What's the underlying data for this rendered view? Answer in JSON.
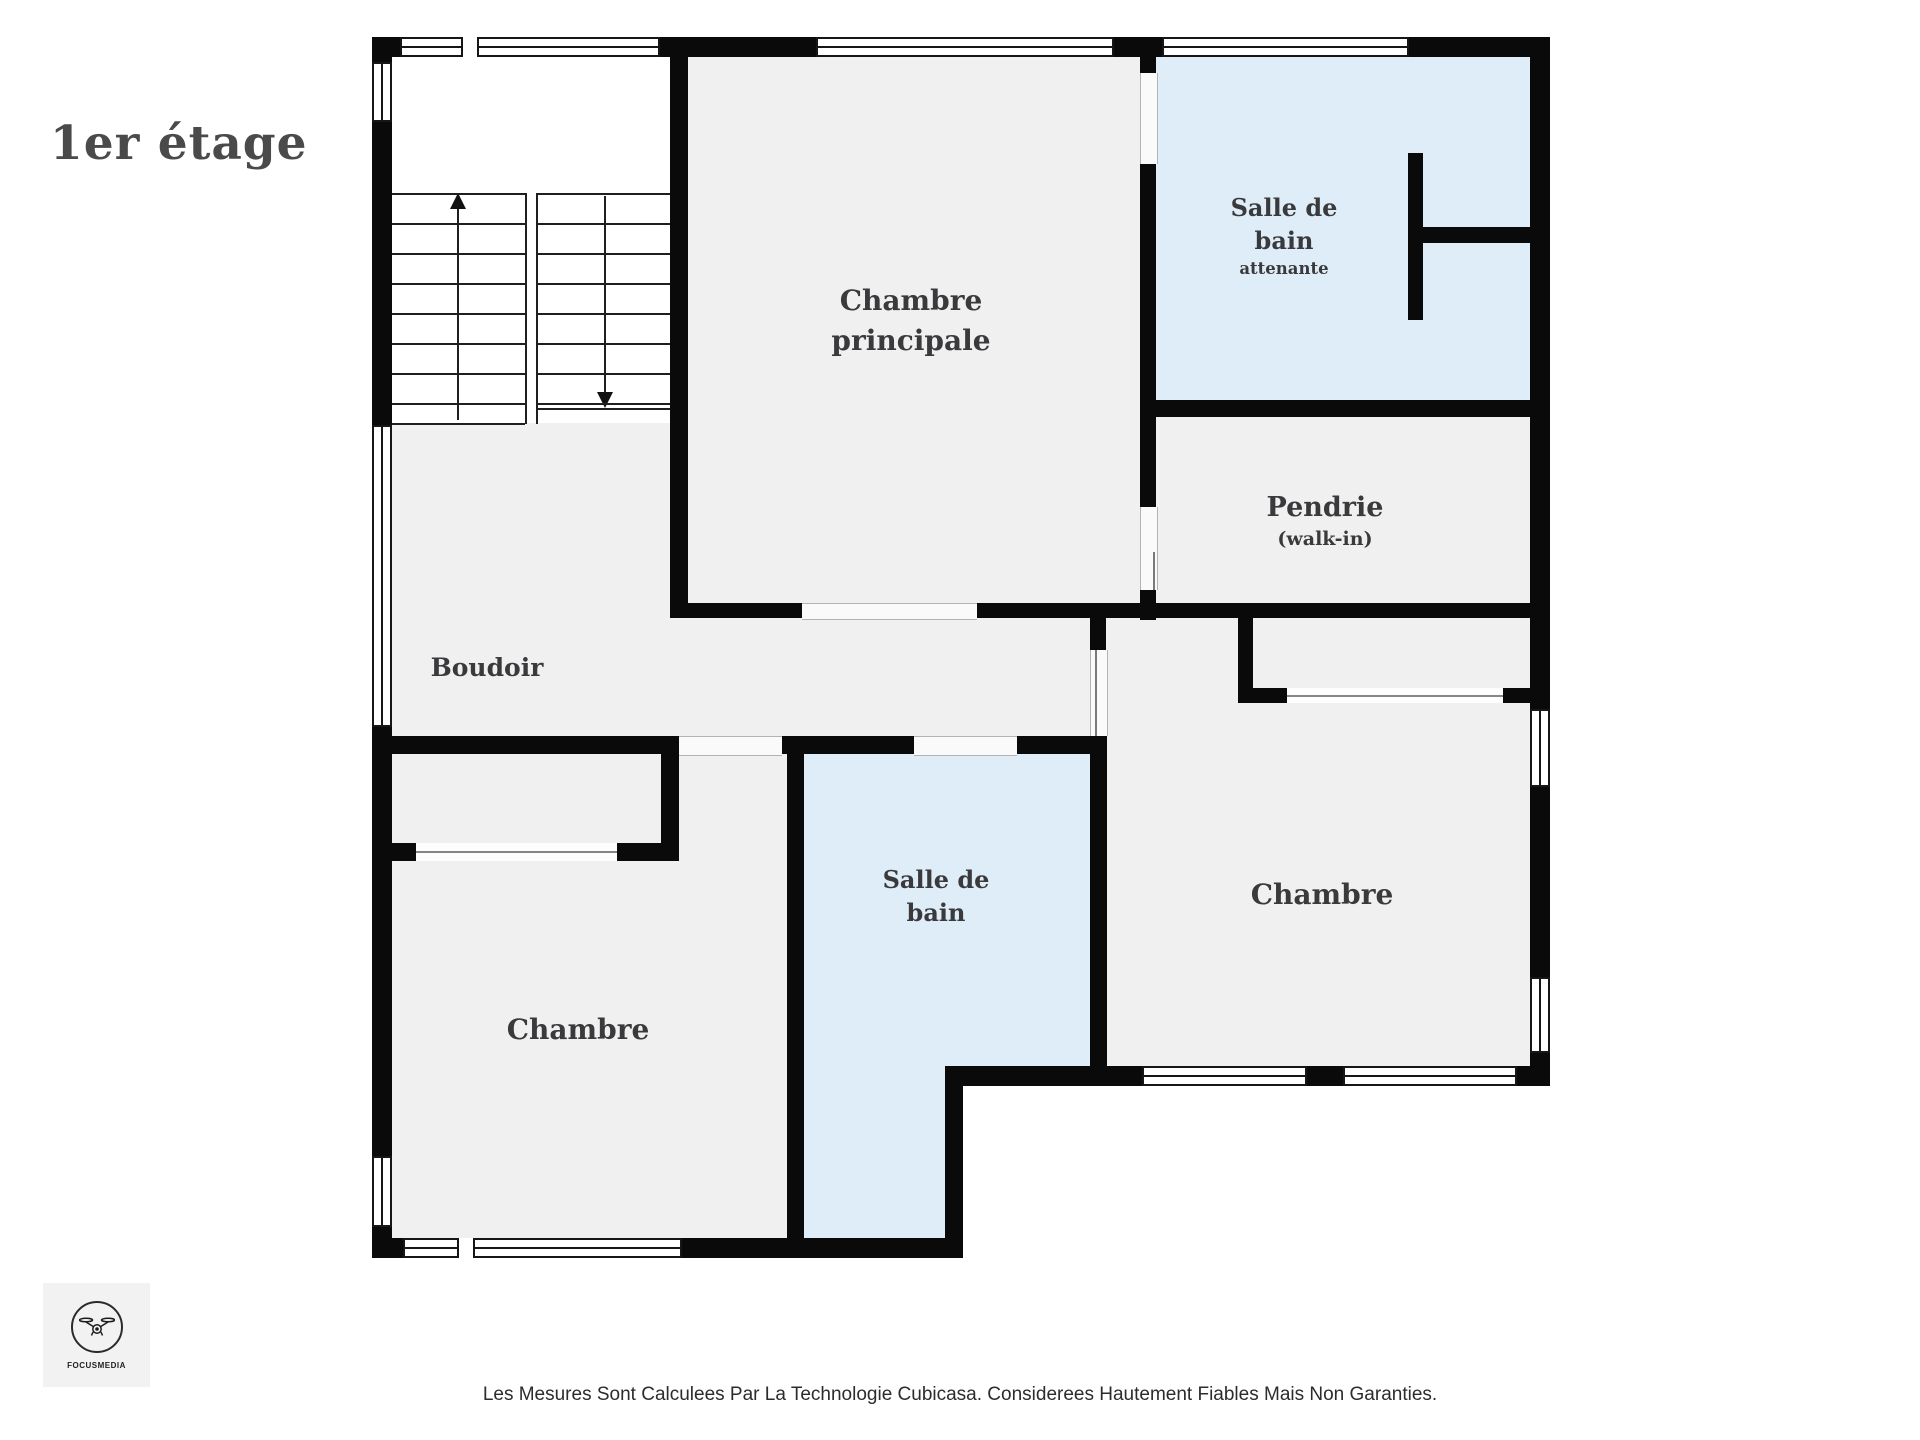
{
  "title": "1er étage",
  "rooms": {
    "master_bedroom": {
      "line1": "Chambre",
      "line2": "principale"
    },
    "ensuite_bathroom": {
      "line1": "Salle de",
      "line2": "bain",
      "line3": "attenante"
    },
    "walk_in": {
      "line1": "Pendrie",
      "line2": "(walk-in)"
    },
    "boudoir": {
      "label": "Boudoir"
    },
    "bedroom_left": {
      "label": "Chambre"
    },
    "bathroom_main": {
      "line1": "Salle de",
      "line2": "bain"
    },
    "bedroom_right": {
      "label": "Chambre"
    }
  },
  "footer": {
    "disclaimer": "Les Mesures Sont Calculees Par La Technologie Cubicasa. Considerees Hautement Fiables Mais Non Garanties."
  },
  "logo": {
    "brand": "FOCUSMEDIA"
  },
  "icons": {
    "logo": "drone-icon",
    "stairs_up": "up-arrow-icon",
    "stairs_down": "down-arrow-icon"
  },
  "colors": {
    "wall": "#0a0a0a",
    "floor": "#f1f0f1",
    "wet_room": "#deedf8",
    "stairwell": "#ffffff",
    "label_text": "#3a3a3c",
    "title_text": "#4a4a4a"
  }
}
